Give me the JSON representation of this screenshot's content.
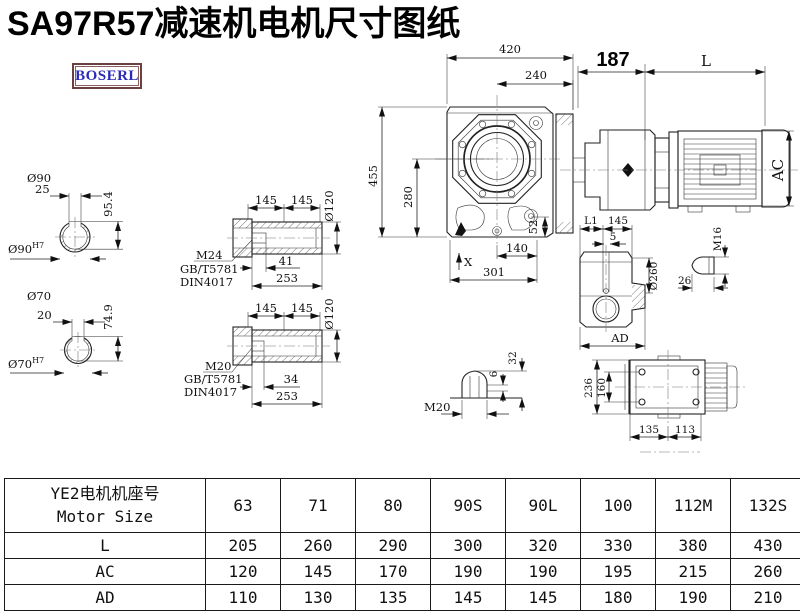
{
  "title": "SA97R57减速机电机尺寸图纸",
  "logo": "BOSERL",
  "drawing": {
    "front_view": {
      "dim_420": "420",
      "dim_240": "240",
      "dim_455": "455",
      "dim_280": "280",
      "dim_52": "52",
      "x_mark": "X",
      "dim_140": "140",
      "dim_301": "301"
    },
    "motor_view": {
      "dim_187": "187",
      "dim_L": "L",
      "dim_AC": "AC"
    },
    "shaft_90": {
      "dia": "Ø90",
      "key_width": "25",
      "key_height": "95.4",
      "fit": "Ø90",
      "fit_sup": "H7"
    },
    "shaft_70": {
      "dia": "Ø70",
      "key_width": "20",
      "key_height": "74.9",
      "fit": "Ø70",
      "fit_sup": "H7"
    },
    "hollow_shaft_m24": {
      "seg1": "145",
      "seg2": "145",
      "dia": "Ø120",
      "thread": "M24",
      "std1": "GB/T5781",
      "std2": "DIN4017",
      "thread_len": "41",
      "total_len": "253"
    },
    "hollow_shaft_m20": {
      "seg1": "145",
      "seg2": "145",
      "dia": "Ø120",
      "thread": "M20",
      "std1": "GB/T5781",
      "std2": "DIN4017",
      "thread_len": "34",
      "total_len": "253"
    },
    "side_view": {
      "dim_l1": "L1",
      "dim_145": "145",
      "dim_5": "5",
      "dia": "Ø260",
      "dim_ad": "AD"
    },
    "plug_m16": {
      "thread": "M16",
      "dim_26": "26"
    },
    "plug_m20": {
      "thread": "M20",
      "dim_6": "6",
      "dim_32": "32"
    },
    "top_view": {
      "dim_236": "236",
      "dim_160": "160",
      "dim_135": "135",
      "dim_113": "113"
    }
  },
  "table": {
    "header": {
      "line1": "YE2电机机座号",
      "line2": "Motor Size",
      "sizes": [
        "63",
        "71",
        "80",
        "90S",
        "90L",
        "100",
        "112M",
        "132S"
      ]
    },
    "rows": [
      {
        "label": "L",
        "values": [
          "205",
          "260",
          "290",
          "300",
          "320",
          "330",
          "380",
          "430"
        ]
      },
      {
        "label": "AC",
        "values": [
          "120",
          "145",
          "170",
          "190",
          "190",
          "195",
          "215",
          "260"
        ]
      },
      {
        "label": "AD",
        "values": [
          "110",
          "130",
          "135",
          "145",
          "145",
          "180",
          "190",
          "210"
        ]
      }
    ]
  }
}
